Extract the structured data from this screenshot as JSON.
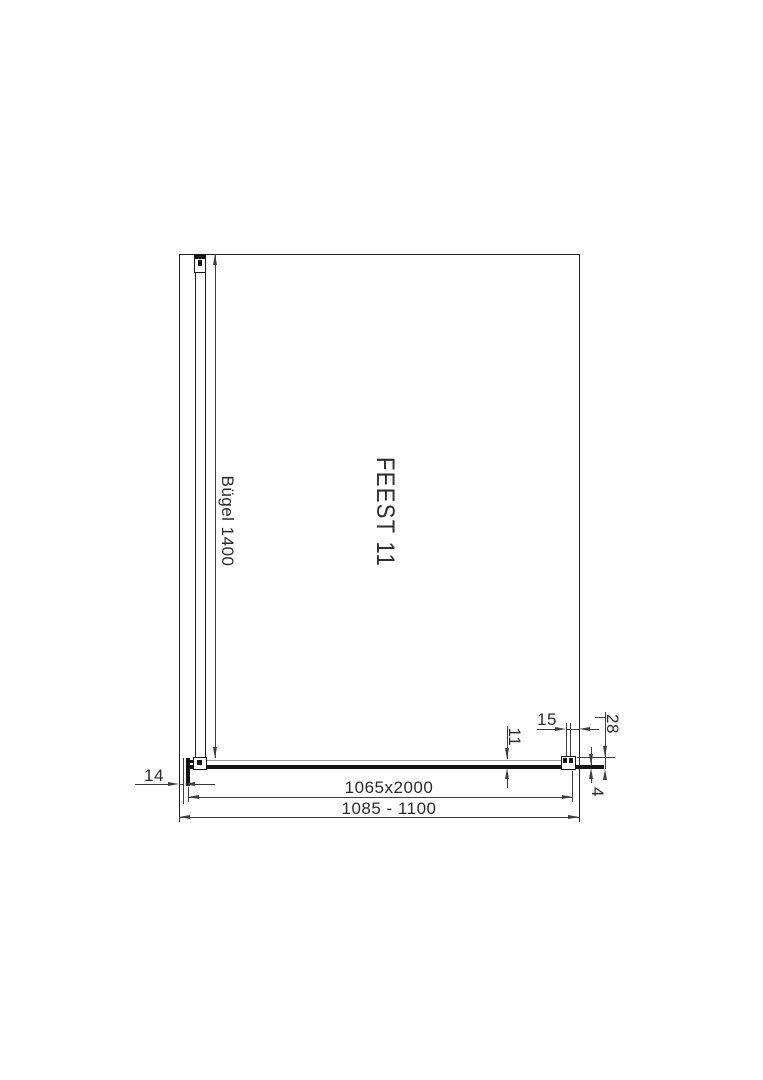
{
  "drawing": {
    "product_label": "FEEST 11",
    "stabilizer_label": "Bügel 1400",
    "dimensions": {
      "glass_size": "1065x2000",
      "niche_width_range": "1085 - 1100",
      "wall_profile_width": "14",
      "panel_thickness": "11",
      "end_clearance": "15",
      "end_bracket_depth": "28",
      "seal_gap": "4"
    },
    "colors": {
      "wall": "#1f1f1f",
      "dim": "#3d3d3d",
      "ink": "#141414",
      "glass": "#9b9b9b",
      "text": "#2b2b2b",
      "bg": "#ffffff"
    }
  }
}
